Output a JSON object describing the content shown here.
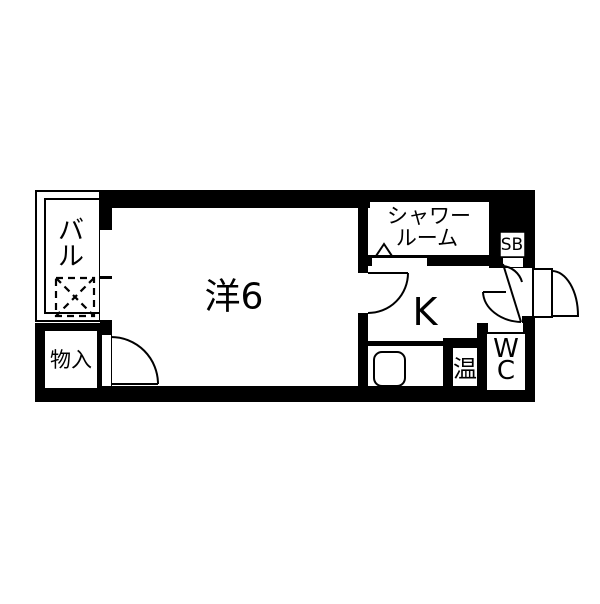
{
  "floorplan": {
    "colors": {
      "wall": "#000000",
      "floor": "#ffffff"
    },
    "rooms": {
      "balcony": {
        "label_chars": [
          "バ",
          "ル"
        ]
      },
      "storage": {
        "label": "物入"
      },
      "western_room": {
        "label": "洋6"
      },
      "shower_room": {
        "label_lines": [
          "シャワー",
          "ルーム"
        ]
      },
      "shoe_box": {
        "label": "SB"
      },
      "kitchen": {
        "label": "K"
      },
      "water_heater": {
        "label": "温"
      },
      "toilet": {
        "label_lines": [
          "W",
          "C"
        ]
      }
    }
  }
}
